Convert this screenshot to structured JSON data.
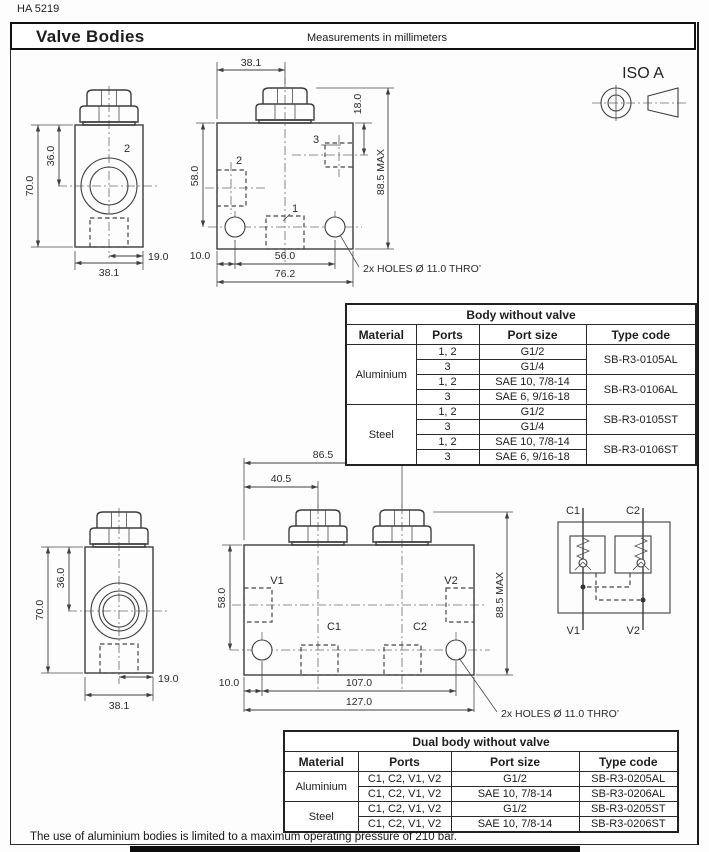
{
  "page": {
    "doc_code": "HA 5219",
    "title": "Valve Bodies",
    "subtitle": "Measurements in millimeters",
    "iso_label": "ISO A",
    "footnote": "The use of aluminium bodies is limited to a maximum operating pressure of 210 bar."
  },
  "single_body": {
    "side": {
      "d70": "70.0",
      "d36": "36.0",
      "d38": "38.1",
      "d19": "19.0",
      "port2": "2"
    },
    "front": {
      "d38": "38.1",
      "d18": "18.0",
      "dmax": "88.5 MAX",
      "d58": "58.0",
      "d10": "10.0",
      "d56": "56.0",
      "d76": "76.2",
      "p1": "1",
      "p2": "2",
      "p3": "3",
      "holes_note": "2x HOLES Ø 11.0 THRO’"
    }
  },
  "dual_body": {
    "side": {
      "d70": "70.0",
      "d36": "36.0",
      "d38": "38.1",
      "d19": "19.0"
    },
    "front": {
      "d86": "86.5",
      "d40": "40.5",
      "d58": "58.0",
      "dmax": "88.5 MAX",
      "d10": "10.0",
      "d107": "107.0",
      "d127": "127.0",
      "v1": "V1",
      "v2": "V2",
      "c1": "C1",
      "c2": "C2",
      "holes_note": "2x HOLES Ø 11.0 THRO’"
    },
    "schematic": {
      "c1": "C1",
      "c2": "C2",
      "v1": "V1",
      "v2": "V2"
    }
  },
  "table_single": {
    "title": "Body without valve",
    "headers": [
      "Material",
      "Ports",
      "Port size",
      "Type code"
    ],
    "groups": [
      {
        "material": "Aluminium",
        "variants": [
          {
            "code": "SB-R3-0105AL",
            "rows": [
              {
                "ports": "1, 2",
                "size": "G1/2"
              },
              {
                "ports": "3",
                "size": "G1/4"
              }
            ]
          },
          {
            "code": "SB-R3-0106AL",
            "rows": [
              {
                "ports": "1, 2",
                "size": "SAE 10, 7/8-14"
              },
              {
                "ports": "3",
                "size": "SAE 6, 9/16-18"
              }
            ]
          }
        ]
      },
      {
        "material": "Steel",
        "variants": [
          {
            "code": "SB-R3-0105ST",
            "rows": [
              {
                "ports": "1, 2",
                "size": "G1/2"
              },
              {
                "ports": "3",
                "size": "G1/4"
              }
            ]
          },
          {
            "code": "SB-R3-0106ST",
            "rows": [
              {
                "ports": "1, 2",
                "size": "SAE 10, 7/8-14"
              },
              {
                "ports": "3",
                "size": "SAE 6, 9/16-18"
              }
            ]
          }
        ]
      }
    ]
  },
  "table_dual": {
    "title": "Dual body without valve",
    "headers": [
      "Material",
      "Ports",
      "Port size",
      "Type code"
    ],
    "groups": [
      {
        "material": "Aluminium",
        "rows": [
          {
            "ports": "C1, C2, V1, V2",
            "size": "G1/2",
            "code": "SB-R3-0205AL"
          },
          {
            "ports": "C1, C2, V1, V2",
            "size": "SAE 10, 7/8-14",
            "code": "SB-R3-0206AL"
          }
        ]
      },
      {
        "material": "Steel",
        "rows": [
          {
            "ports": "C1, C2, V1, V2",
            "size": "G1/2",
            "code": "SB-R3-0205ST"
          },
          {
            "ports": "C1, C2, V1, V2",
            "size": "SAE 10, 7/8-14",
            "code": "SB-R3-0206ST"
          }
        ]
      }
    ]
  }
}
